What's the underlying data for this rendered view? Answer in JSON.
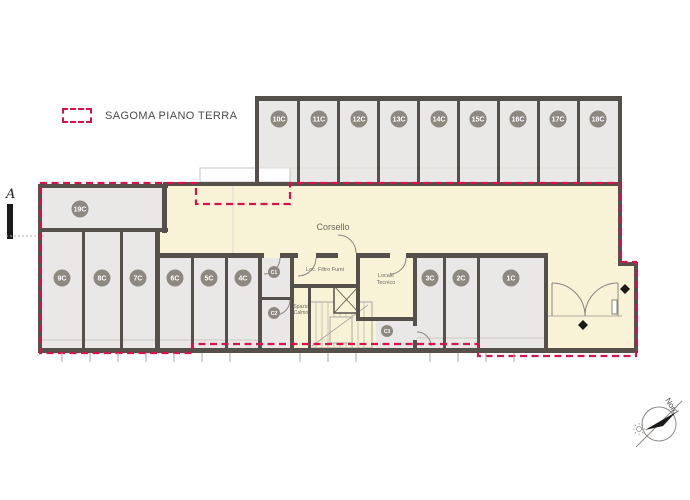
{
  "legend": {
    "label": "SAGOMA PIANO TERRA"
  },
  "section_marker": {
    "label": "A"
  },
  "plan": {
    "corsello_label": "Corsello",
    "room_labels": {
      "filtro_fumi": "Loc. Filtro Fumi",
      "locale_tecnico_line1": "Locale",
      "locale_tecnico_line2": "Tecnico",
      "spazio_calmo_line1": "Spazio",
      "spazio_calmo_line2": "Calmo"
    },
    "stalls_top": [
      "10C",
      "11C",
      "12C",
      "13C",
      "14C",
      "15C",
      "16C",
      "17C",
      "18C"
    ],
    "stall_left": "19C",
    "stalls_bottom": [
      "9C",
      "8C",
      "7C",
      "6C",
      "5C",
      "4C",
      "3C",
      "2C",
      "1C"
    ],
    "storage_badges": [
      "C1",
      "C2",
      "C3"
    ],
    "colors": {
      "ground_floor_outline": "#d8134b",
      "wall": "#55504a",
      "stall_fill": "#e9e8e6",
      "drive_aisle_fill": "#f8f2d7",
      "badge_fill": "#8d8880"
    }
  },
  "compass": {
    "north_label": "Nord"
  }
}
